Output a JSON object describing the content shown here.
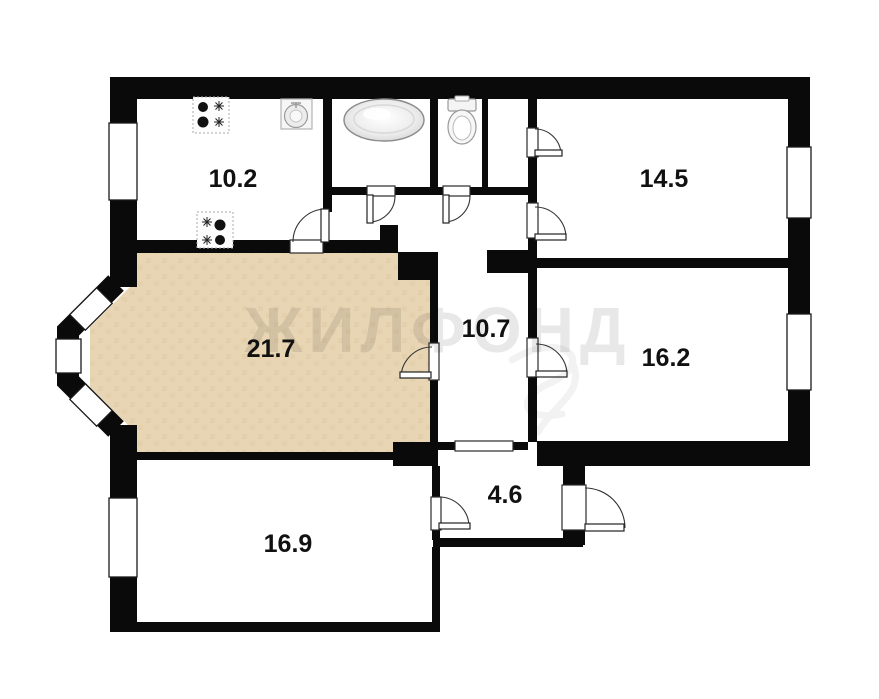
{
  "watermark": {
    "text": "ЖИЛФОНД"
  },
  "colors": {
    "wall": "#0a0a0a",
    "highlighted_room_fill": "#e8d5b4",
    "background": "#ffffff"
  },
  "rooms": [
    {
      "name": "kitchen",
      "area_label": "10.2"
    },
    {
      "name": "room-14-5",
      "area_label": "14.5"
    },
    {
      "name": "living-room",
      "area_label": "21.7",
      "highlighted": true
    },
    {
      "name": "hallway",
      "area_label": "10.7"
    },
    {
      "name": "room-16-2",
      "area_label": "16.2"
    },
    {
      "name": "room-16-9",
      "area_label": "16.9"
    },
    {
      "name": "entry-hall",
      "area_label": "4.6"
    }
  ],
  "fixtures": [
    {
      "name": "stove-burners-top"
    },
    {
      "name": "kitchen-sink"
    },
    {
      "name": "bathtub"
    },
    {
      "name": "toilet"
    },
    {
      "name": "stove-burners-bottom"
    }
  ]
}
